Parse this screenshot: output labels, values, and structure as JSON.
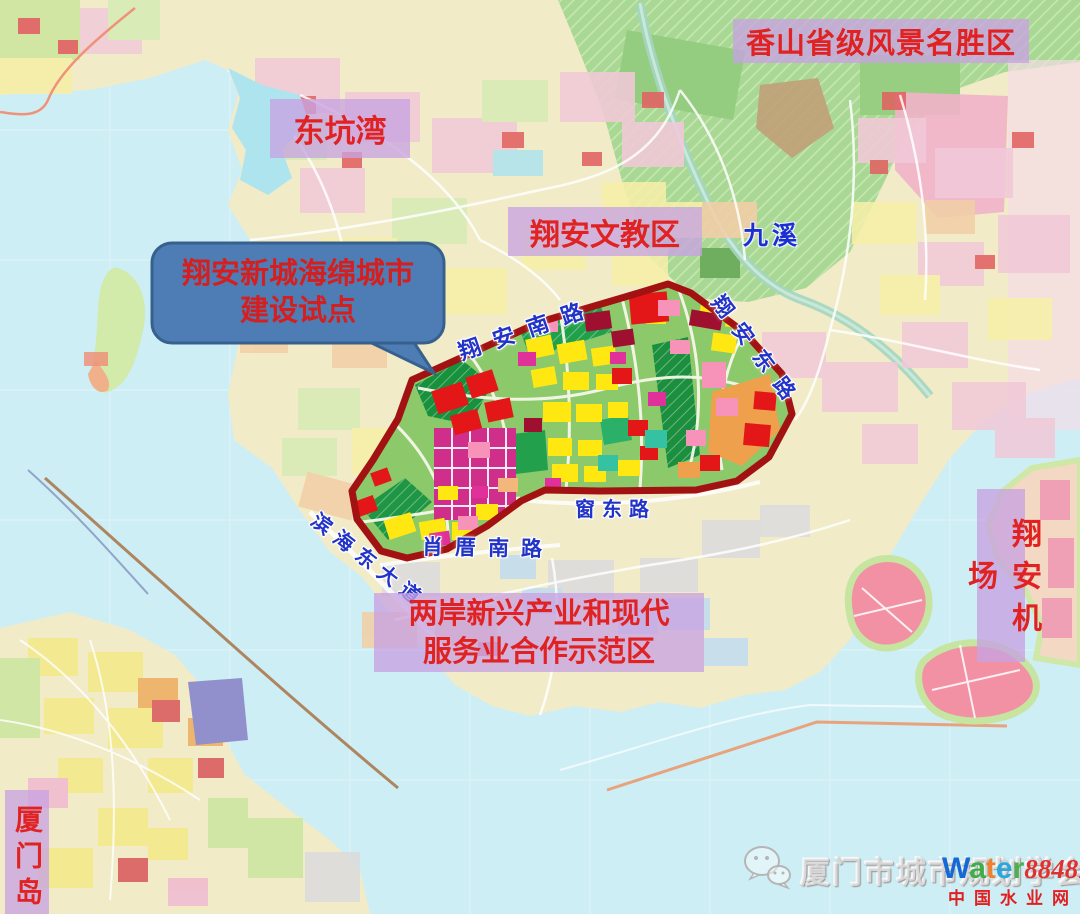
{
  "labels": {
    "xiangshan": "香山省级风景名胜区",
    "dongkengwan": "东坑湾",
    "wenjiao": "翔安文教区",
    "jiuxi": "九溪",
    "hezuo_line1": "两岸新兴产业和现代",
    "hezuo_line2": "服务业合作示范区",
    "airport": "翔安机场",
    "xiamen_island": "厦门岛"
  },
  "callout": {
    "line1": "翔安新城海绵城市",
    "line2": "建设试点"
  },
  "roads": {
    "xiangan_south": "翔安南路",
    "xiangan_east": "翔安东路",
    "binhai_east": "滨海东大道",
    "xiaocuo_south": "肖厝南路",
    "chuangdong": "窗东路"
  },
  "watermark": {
    "society": "厦门市城市规划学会",
    "brand_letters": [
      "W",
      "a",
      "t",
      "e",
      "r"
    ],
    "brand_8848": "8848",
    "brand_com": ".com",
    "brand_cn": "中国水业网"
  },
  "colors": {
    "water": "#cdeef5",
    "land": "#f1ebc8",
    "scenic_green": "#a9d794",
    "label_bg": "#c8a3e2",
    "label_text": "#e02222",
    "road_label_text": "#2233c8",
    "pilot_border": "#a31212",
    "callout_fill": "#4d7db4"
  }
}
